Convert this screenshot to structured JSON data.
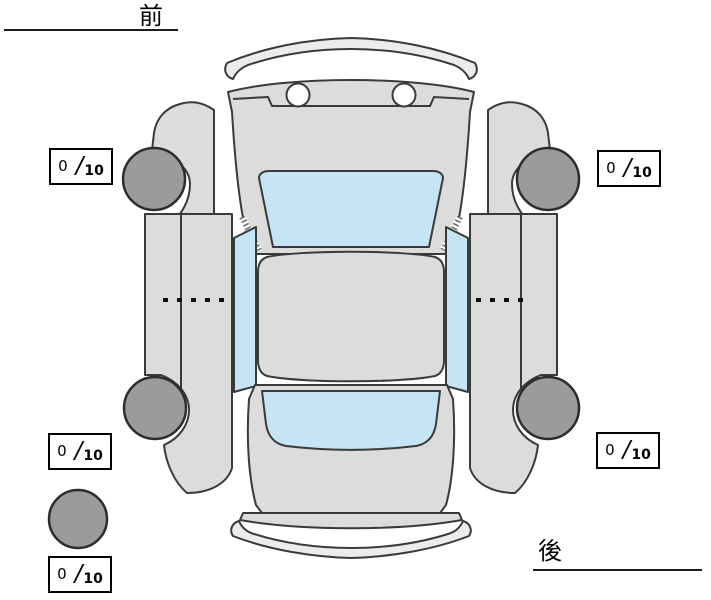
{
  "diagram": {
    "type": "vehicle-condition-top-view",
    "front_label": "前",
    "rear_label": "後"
  },
  "scores": {
    "separator": "/",
    "front_left": {
      "value": "0",
      "max": "10"
    },
    "front_right": {
      "value": "0",
      "max": "10"
    },
    "rear_left": {
      "value": "0",
      "max": "10"
    },
    "rear_right": {
      "value": "0",
      "max": "10"
    },
    "spare": {
      "value": "0",
      "max": "10"
    }
  },
  "colors": {
    "body": "#dcdcdc",
    "bumper": "#ececec",
    "glass": "#c5e4f5",
    "tire": "#9b9b9b",
    "outline": "#3a3a3a"
  }
}
